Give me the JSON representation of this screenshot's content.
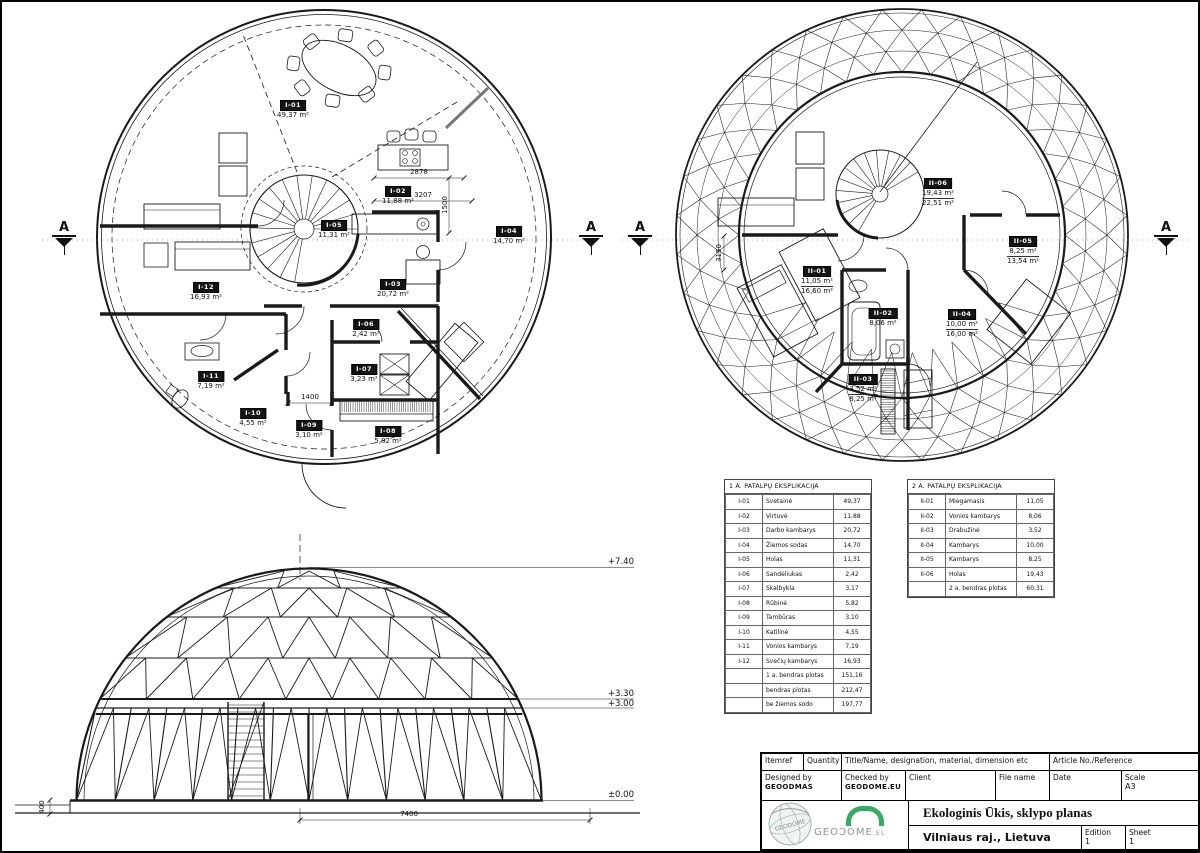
{
  "sheet": {
    "section_marker": "A"
  },
  "plan1": {
    "rooms": [
      {
        "id": "I-01",
        "area": "49,37 m²"
      },
      {
        "id": "I-02",
        "area": "11,88 m²"
      },
      {
        "id": "I-03",
        "area": "20,72 m²"
      },
      {
        "id": "I-04",
        "area": "14,70 m²"
      },
      {
        "id": "I-05",
        "area": "11,31 m²"
      },
      {
        "id": "I-06",
        "area": "2,42 m²"
      },
      {
        "id": "I-07",
        "area": "3,23 m²"
      },
      {
        "id": "I-08",
        "area": "5,82 m²"
      },
      {
        "id": "I-09",
        "area": "3,10 m²"
      },
      {
        "id": "I-10",
        "area": "4,55 m²"
      },
      {
        "id": "I-11",
        "area": "7,19 m²"
      },
      {
        "id": "I-12",
        "area": "16,93 m²"
      }
    ],
    "dims": {
      "d2878": "2878",
      "d3207": "3207",
      "d1500": "1500",
      "d1400": "1400"
    }
  },
  "plan2": {
    "rooms": [
      {
        "id": "II-01",
        "area": "11,05 m²",
        "area2": "16,60 m²"
      },
      {
        "id": "II-02",
        "area": "8,06 m²"
      },
      {
        "id": "II-03",
        "area": "3,52 m²",
        "area2": "8,25 m²"
      },
      {
        "id": "II-04",
        "area": "10,00 m²",
        "area2": "16,00 m²"
      },
      {
        "id": "II-05",
        "area": "8,25 m²",
        "area2": "13,54 m²"
      },
      {
        "id": "II-06",
        "area": "19,43 m²",
        "area2": "22,51 m²"
      }
    ],
    "dims": {
      "d3150": "3150"
    }
  },
  "elevation": {
    "levels": {
      "top": "+7.40",
      "upper": "+3.30",
      "lower": "+3.00",
      "ground": "±0.00"
    },
    "dims": {
      "width": "7400",
      "plinth": "400"
    }
  },
  "tables": [
    {
      "title": "1 A. PATALPŲ EKSPLIKACIJA",
      "rows": [
        [
          "I-01",
          "Svetainė",
          "49,37"
        ],
        [
          "I-02",
          "Virtuvė",
          "11,88"
        ],
        [
          "I-03",
          "Darbo kambarys",
          "20,72"
        ],
        [
          "I-04",
          "Žiemos sodas",
          "14,70"
        ],
        [
          "I-05",
          "Holas",
          "11,31"
        ],
        [
          "I-06",
          "Sandėliukas",
          "2,42"
        ],
        [
          "I-07",
          "Skalbykla",
          "3,17"
        ],
        [
          "I-08",
          "Rūbinė",
          "5,82"
        ],
        [
          "I-09",
          "Tambūras",
          "3,10"
        ],
        [
          "I-10",
          "Katilinė",
          "4,55"
        ],
        [
          "I-11",
          "Vonios kambarys",
          "7,19"
        ],
        [
          "I-12",
          "Svečių kambarys",
          "16,93"
        ],
        [
          "",
          "1 a. bendras plotas",
          "151,16"
        ],
        [
          "",
          "bendras plotas",
          "212,47"
        ],
        [
          "",
          "be žiemos sodo",
          "197,77"
        ]
      ]
    },
    {
      "title": "2 A. PATALPŲ EKSPLIKACIJA",
      "rows": [
        [
          "II-01",
          "Miegamasis",
          "11,05"
        ],
        [
          "II-02",
          "Vonios kambarys",
          "8,06"
        ],
        [
          "II-03",
          "Drabužinė",
          "3,52"
        ],
        [
          "II-04",
          "Kambarys",
          "10,00"
        ],
        [
          "II-05",
          "Kambarys",
          "8,25"
        ],
        [
          "II-06",
          "Holas",
          "19,43"
        ],
        [
          "",
          "2 a. bendras plotas",
          "60,31"
        ]
      ]
    }
  ],
  "titleblock": {
    "itemref_label": "Itemref",
    "quantity_label": "Quantity",
    "title_col_label": "Title/Name, designation, material, dimension etc",
    "article_label": "Article No./Reference",
    "designed_by_label": "Designed by",
    "designed_by": "GEOODMAS",
    "checked_by_label": "Checked by",
    "checked_by": "GEODOME.EU",
    "client_label": "Client",
    "file_name_label": "File name",
    "date_label": "Date",
    "scale_label": "Scale",
    "scale_value": "A3",
    "project_title": "Ekologinis Ūkis, sklypo planas",
    "location": "Vilniaus raj., Lietuva",
    "edition_label": "Edition",
    "edition_value": "1",
    "sheet_label": "Sheet",
    "sheet_value": "1",
    "logo_text": "GEOƆOME",
    "logo_tld": ".EL",
    "stamp_text": "GEODOME"
  }
}
